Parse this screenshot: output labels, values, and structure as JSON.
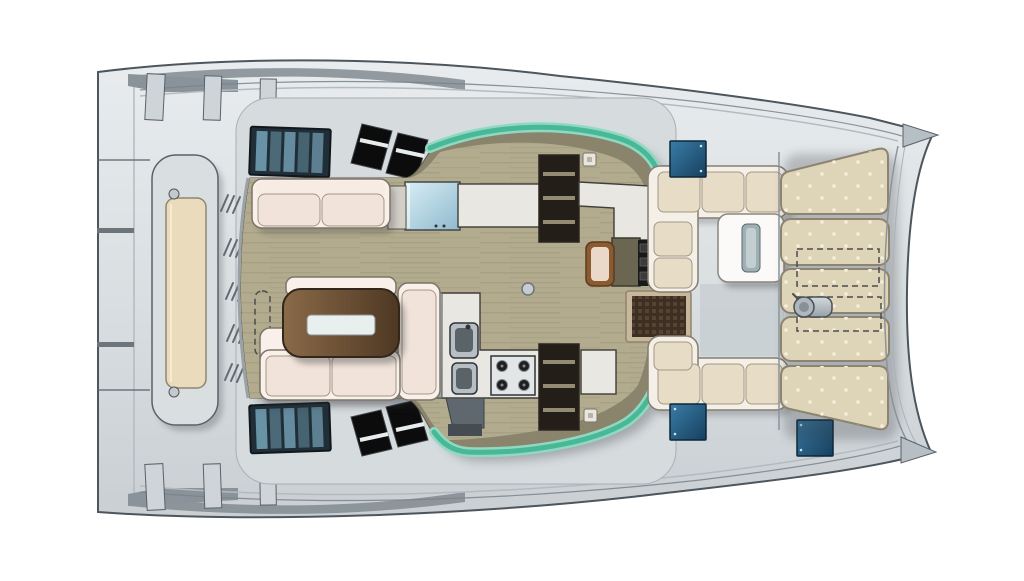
{
  "plan": {
    "kind": "catamaran-deck-plan",
    "features": {
      "sunpad_cushion_count": 5,
      "deck_hatch_count": 3,
      "stove_burner_count": 4,
      "sink_bowl_count": 2,
      "stairway_count": 2,
      "skylight_count": 4,
      "vent_grille_groups": 5
    }
  },
  "colors": {
    "background": "#ffffff",
    "hull_light": "#e8ecee",
    "hull_mid": "#dadfe2",
    "hull_dark": "#c9cfd3",
    "coachroof": "#d6dbde",
    "shadow_band": "#7d868c",
    "saloon_floor": "#b2ab8d",
    "floor_grain": "#8f8870",
    "cabinet_band": "#8a846d",
    "glass_teal": "#49b896",
    "glass_teal_light": "#8fd9c2",
    "sofa_cream": "#f1e3d9",
    "sofa_light": "#f9f0e9",
    "table_wood_light": "#8a6a48",
    "table_wood_dark": "#4e3823",
    "table_inset": "#e9efed",
    "counter": "#e9e7e2",
    "steel_light": "#d3dade",
    "steel_dark": "#97a1a7",
    "glasstop_light": "#d8eef5",
    "glasstop_dark": "#8fb9cd",
    "stair_well": "#231f18",
    "stair_tread": "#948b74",
    "hatch_blue_light": "#3a7ca6",
    "hatch_blue_dark": "#16405f",
    "hull_window": "#202f37",
    "hull_window_pane": "#76a3b8",
    "skylight": "#0c0c0c",
    "sunpad": "#ded4b8",
    "sunpad_dot": "#f6efdc",
    "bench_cushion": "#e7dcc6",
    "bench_frame": "#f4f0e8",
    "aft_bench_cushion": "#e9dbbc",
    "cockpit_table": "#fbfaf8",
    "table_slot": "#9fb0b4",
    "entry_mat": "#3d2f23",
    "mat_frame": "#c8b89b",
    "nav_chair_wood": "#8a5a30",
    "nav_chair_cushion": "#ead9c8",
    "nav_desk": "#6b6652",
    "shadow": "#2f3237"
  }
}
